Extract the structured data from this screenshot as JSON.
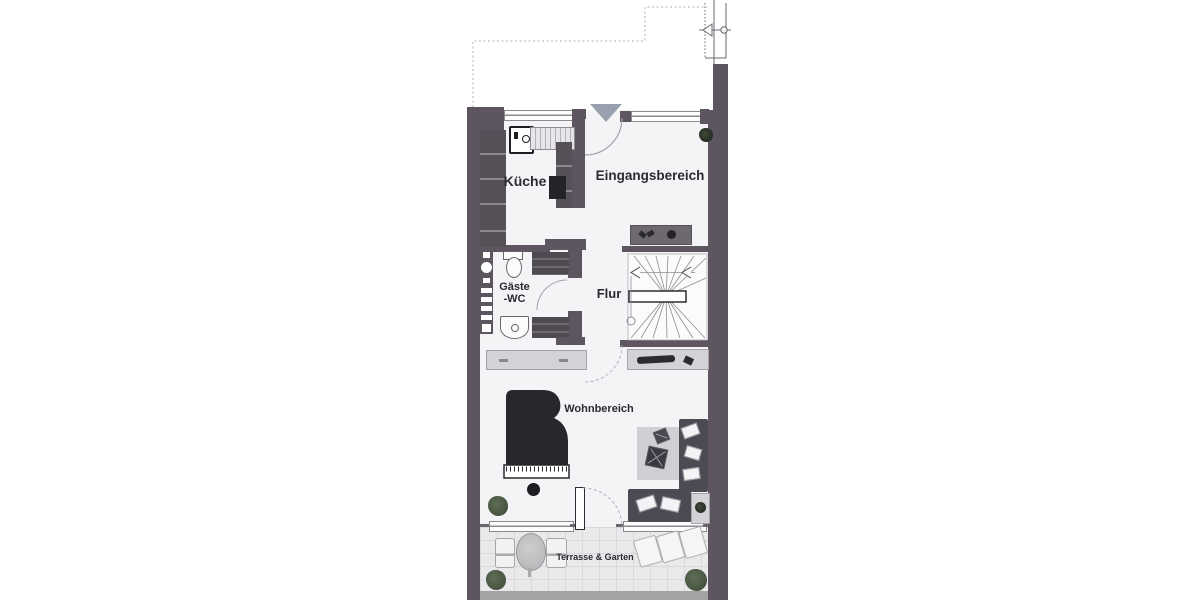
{
  "rooms": {
    "kitchen": {
      "label": "Küche"
    },
    "entrance": {
      "label": "Eingangsbereich"
    },
    "guest_wc": {
      "label_line1": "Gäste",
      "label_line2": "-WC"
    },
    "hallway": {
      "label": "Flur"
    },
    "living": {
      "label": "Wohnbereich"
    },
    "terrace": {
      "label": "Terrasse & Garten"
    }
  },
  "colors": {
    "wall": "#5d5560",
    "furniture-dark": "#4c4b53",
    "piano": "#28272c",
    "furniture-light": "#d3d2d7",
    "paving": "#e9e9eb",
    "plant": "#46523f",
    "entrance-arrow": "#9aa1ae",
    "label-text": "#2b2a2f",
    "line": "#8f8b92"
  },
  "fixtures": [
    "sink-icon",
    "kitchen-counter",
    "kitchen-cabinets",
    "oven-icon",
    "toilet-icon",
    "washbasin-icon",
    "glass-block-window",
    "staircase",
    "stair-handrail",
    "grand-piano-icon",
    "piano-stool-icon",
    "sofa",
    "sofa-cushion",
    "coffee-table-icon",
    "side-table-icon",
    "rug",
    "sideboard",
    "terrace-table-icon",
    "terrace-chair-icon",
    "sunlounger-icon",
    "plant-icon",
    "entrance-arrow-icon",
    "section-marker-icon",
    "roof-outline",
    "door-arc",
    "window"
  ]
}
